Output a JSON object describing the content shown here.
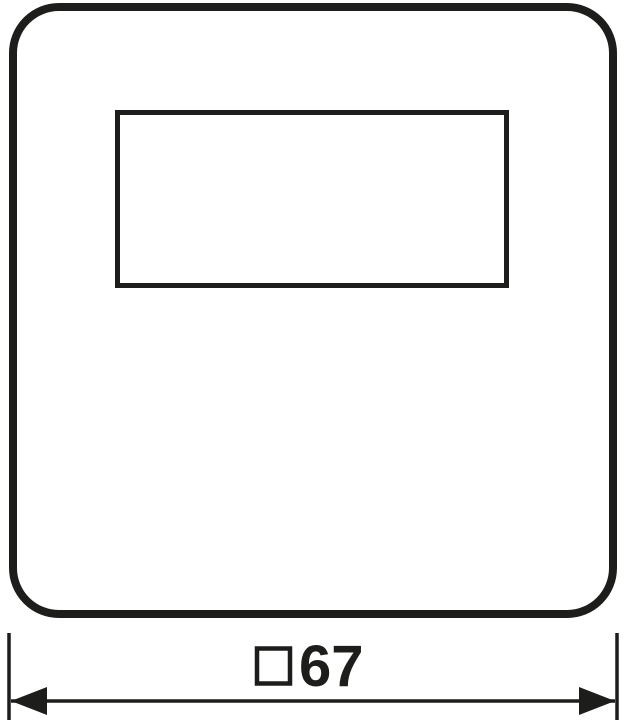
{
  "drawing": {
    "kind": "technical-dimension-drawing",
    "subject": "square cover plate with rectangular window cutout"
  },
  "dimension": {
    "symbol": "□",
    "value": "67",
    "label": "□67"
  },
  "colors": {
    "line": "#1d1d1b",
    "background": "#ffffff"
  }
}
